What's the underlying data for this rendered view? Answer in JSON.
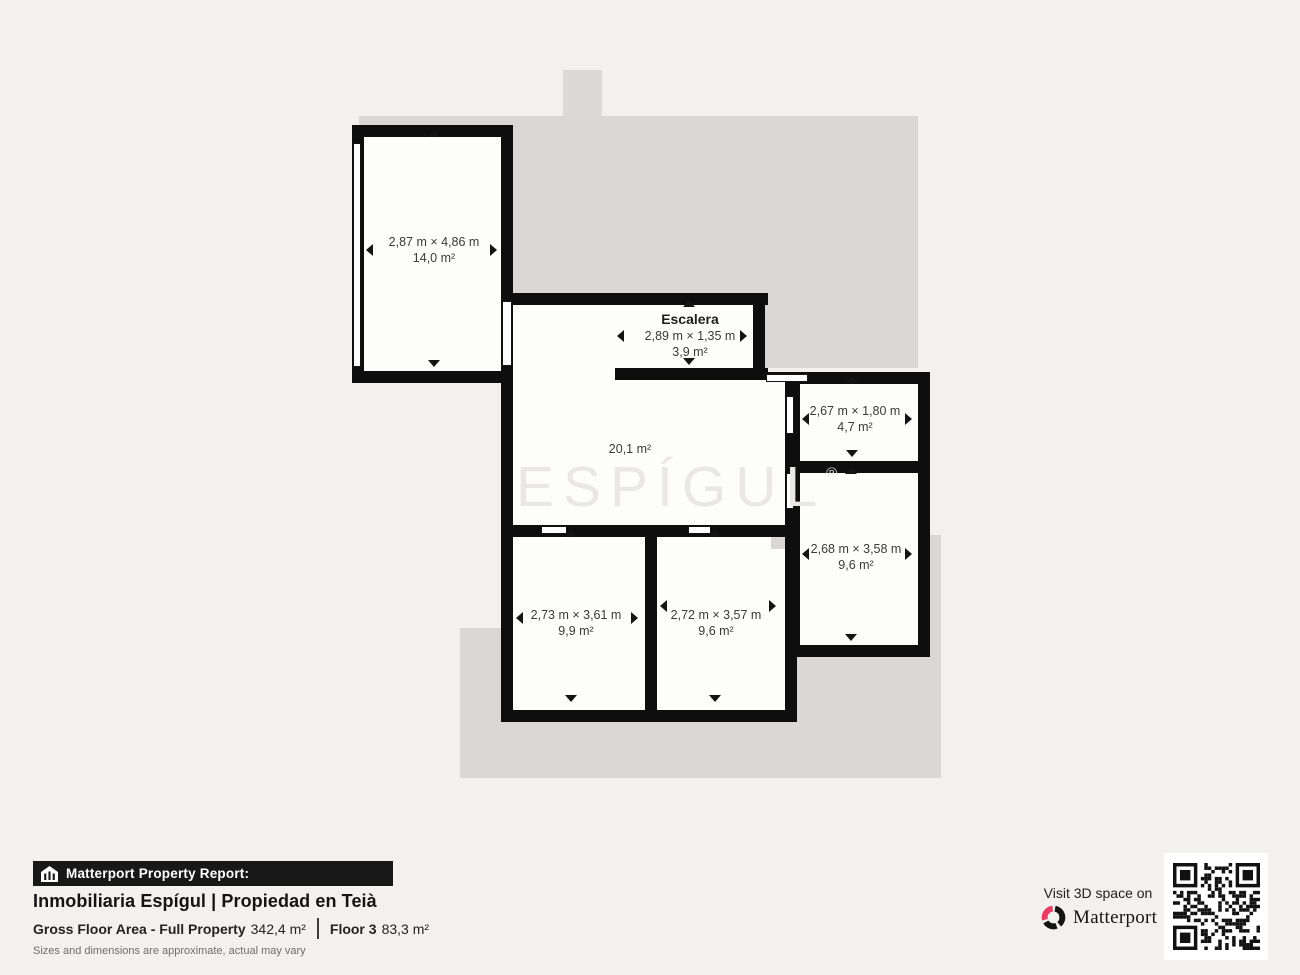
{
  "plan": {
    "watermark": {
      "text": "ESPÍGUL",
      "reg": "®"
    },
    "rooms": [
      {
        "key": "bedroom-top-left",
        "dims": "2,87 m × 4,86 m",
        "area": "14,0 m²"
      },
      {
        "key": "escalera",
        "name": "Escalera",
        "dims": "2,89 m × 1,35 m",
        "area": "3,9 m²"
      },
      {
        "key": "living",
        "area": "20,1 m²"
      },
      {
        "key": "bath",
        "dims": "2,67 m × 1,80 m",
        "area": "4,7 m²"
      },
      {
        "key": "bedroom-right",
        "dims": "2,68 m × 3,58 m",
        "area": "9,6 m²"
      },
      {
        "key": "bedroom-bottom-left",
        "dims": "2,73 m × 3,61 m",
        "area": "9,9 m²"
      },
      {
        "key": "bedroom-bottom-mid",
        "dims": "2,72 m × 3,57 m",
        "area": "9,6 m²"
      }
    ]
  },
  "footer": {
    "report_label": "Matterport Property Report:",
    "title": "Inmobiliaria Espígul | Propiedad en Teià",
    "gross_label": "Gross Floor Area - Full Property",
    "gross_value": "342,4 m²",
    "floor_label": "Floor 3",
    "floor_value": "83,3 m²",
    "disclaimer": "Sizes and dimensions are approximate, actual may vary",
    "visit": "Visit 3D space on",
    "brand": "Matterport"
  },
  "colors": {
    "background": "#f3f1ee",
    "footprint_gray": "#d9d8d6",
    "wall_black": "#0e0e0e",
    "brand_pink": "#e73d64"
  }
}
